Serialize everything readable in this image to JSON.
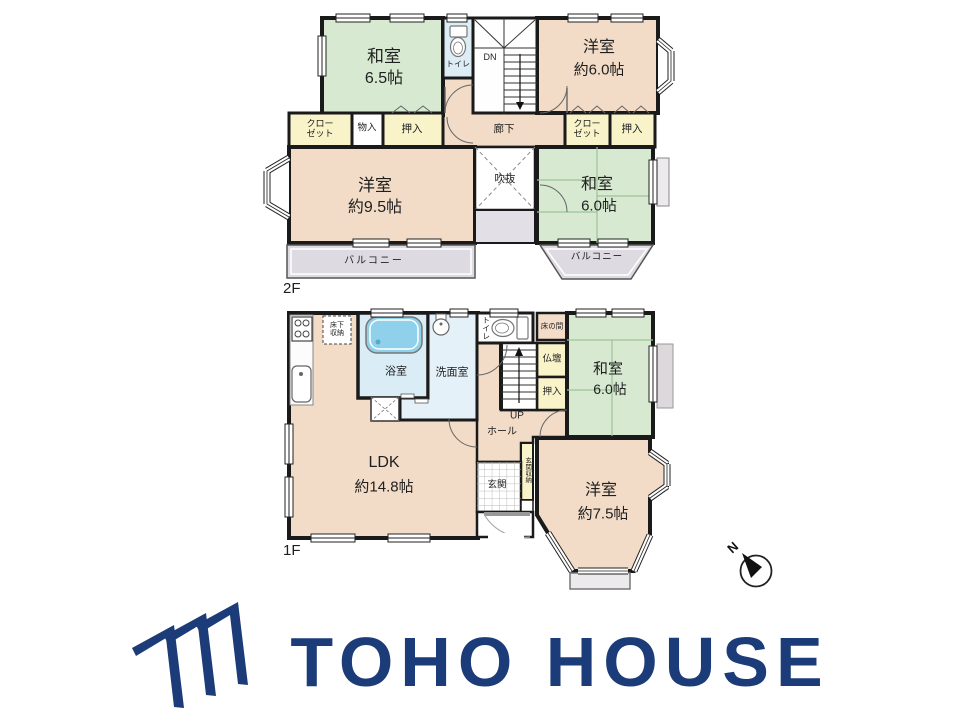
{
  "colors": {
    "wall": "#1a1a1a",
    "room_beige": "#f2dcc7",
    "tatami_green": "#d7ead1",
    "storage_yellow": "#f8f3c9",
    "bath_blue": "#daecf5",
    "tub_blue": "#8fd0ea",
    "balcony_gray": "#dedae2",
    "logo_navy": "#1b3c78"
  },
  "floor2": {
    "floor_label": "2F",
    "rooms": {
      "washitsu65": {
        "name": "和室",
        "size": "6.5帖"
      },
      "toilet": {
        "label": "トイレ"
      },
      "stairs_down": {
        "label": "DN"
      },
      "yoshitsu60": {
        "name": "洋室",
        "size": "約6.0帖"
      },
      "closet_left": {
        "line1": "クロー",
        "line2": "ゼット"
      },
      "monoire": {
        "label": "物入"
      },
      "oshiire_left": {
        "label": "押入"
      },
      "rouka": {
        "label": "廊下"
      },
      "closet_right": {
        "line1": "クロー",
        "line2": "ゼット"
      },
      "oshiire_right": {
        "label": "押入"
      },
      "yoshitsu95": {
        "name": "洋室",
        "size": "約9.5帖"
      },
      "fukinuke": {
        "label": "吹抜"
      },
      "washitsu60": {
        "name": "和室",
        "size": "6.0帖"
      },
      "balcony_left": {
        "label": "バルコニー"
      },
      "balcony_right": {
        "label": "バルコニー"
      }
    }
  },
  "floor1": {
    "floor_label": "1F",
    "rooms": {
      "yukashita": {
        "line1": "床下",
        "line2": "収納"
      },
      "bath": {
        "label": "浴室"
      },
      "senmen": {
        "label": "洗面室"
      },
      "toilet": {
        "label": "トイレ"
      },
      "tokonoma": {
        "label": "床の間"
      },
      "butsudan": {
        "label": "仏壇"
      },
      "oshiire": {
        "label": "押入"
      },
      "washitsu60": {
        "name": "和室",
        "size": "6.0帖"
      },
      "stairs_up": {
        "label": "UP"
      },
      "hall": {
        "label": "ホール"
      },
      "genkan_storage": {
        "label": "玄関収納"
      },
      "genkan": {
        "label": "玄関"
      },
      "ldk": {
        "name": "LDK",
        "size": "約14.8帖"
      },
      "yoshitsu75": {
        "name": "洋室",
        "size": "約7.5帖"
      }
    }
  },
  "compass": {
    "north_label": "N"
  },
  "logo": {
    "text": "TOHO HOUSE"
  }
}
